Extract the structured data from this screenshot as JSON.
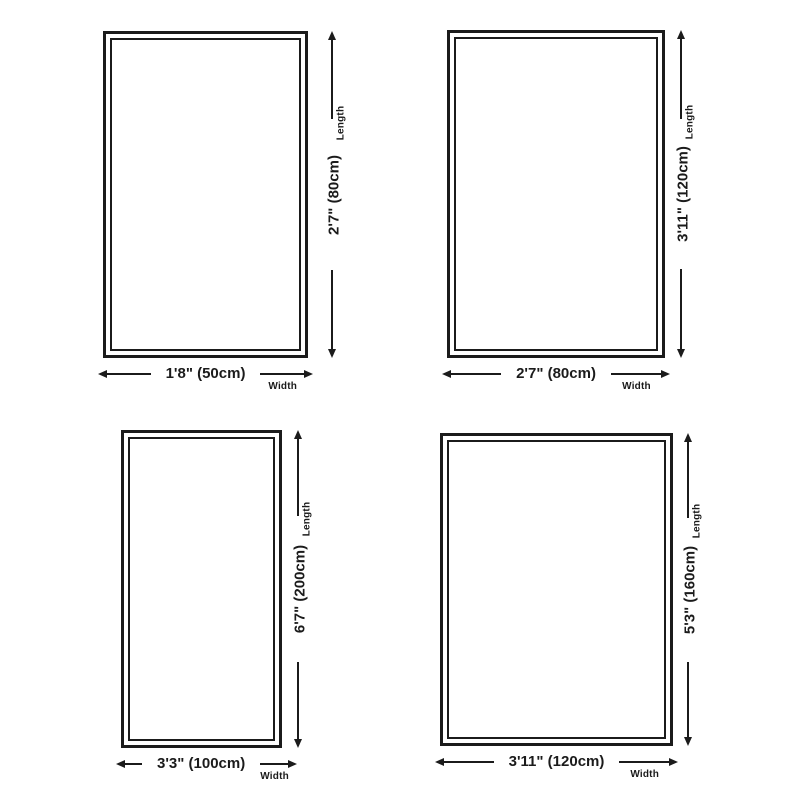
{
  "page": {
    "background_color": "#ffffff",
    "ink_color": "#1b1b1b",
    "description_labels": {
      "length": "Length",
      "width": "Width"
    }
  },
  "panels": [
    {
      "length_label": "Length",
      "width_label": "Width",
      "length_dimension": "2'7\" (80cm)",
      "width_dimension": "1'8\" (50cm)"
    },
    {
      "length_label": "Length",
      "width_label": "Width",
      "length_dimension": "3'11\" (120cm)",
      "width_dimension": "2'7\" (80cm)"
    },
    {
      "length_label": "Length",
      "width_label": "Width",
      "length_dimension": "6'7\" (200cm)",
      "width_dimension": "3'3\" (100cm)"
    },
    {
      "length_label": "Length",
      "width_label": "Width",
      "length_dimension": "5'3\" (160cm)",
      "width_dimension": "3'11\" (120cm)"
    }
  ]
}
